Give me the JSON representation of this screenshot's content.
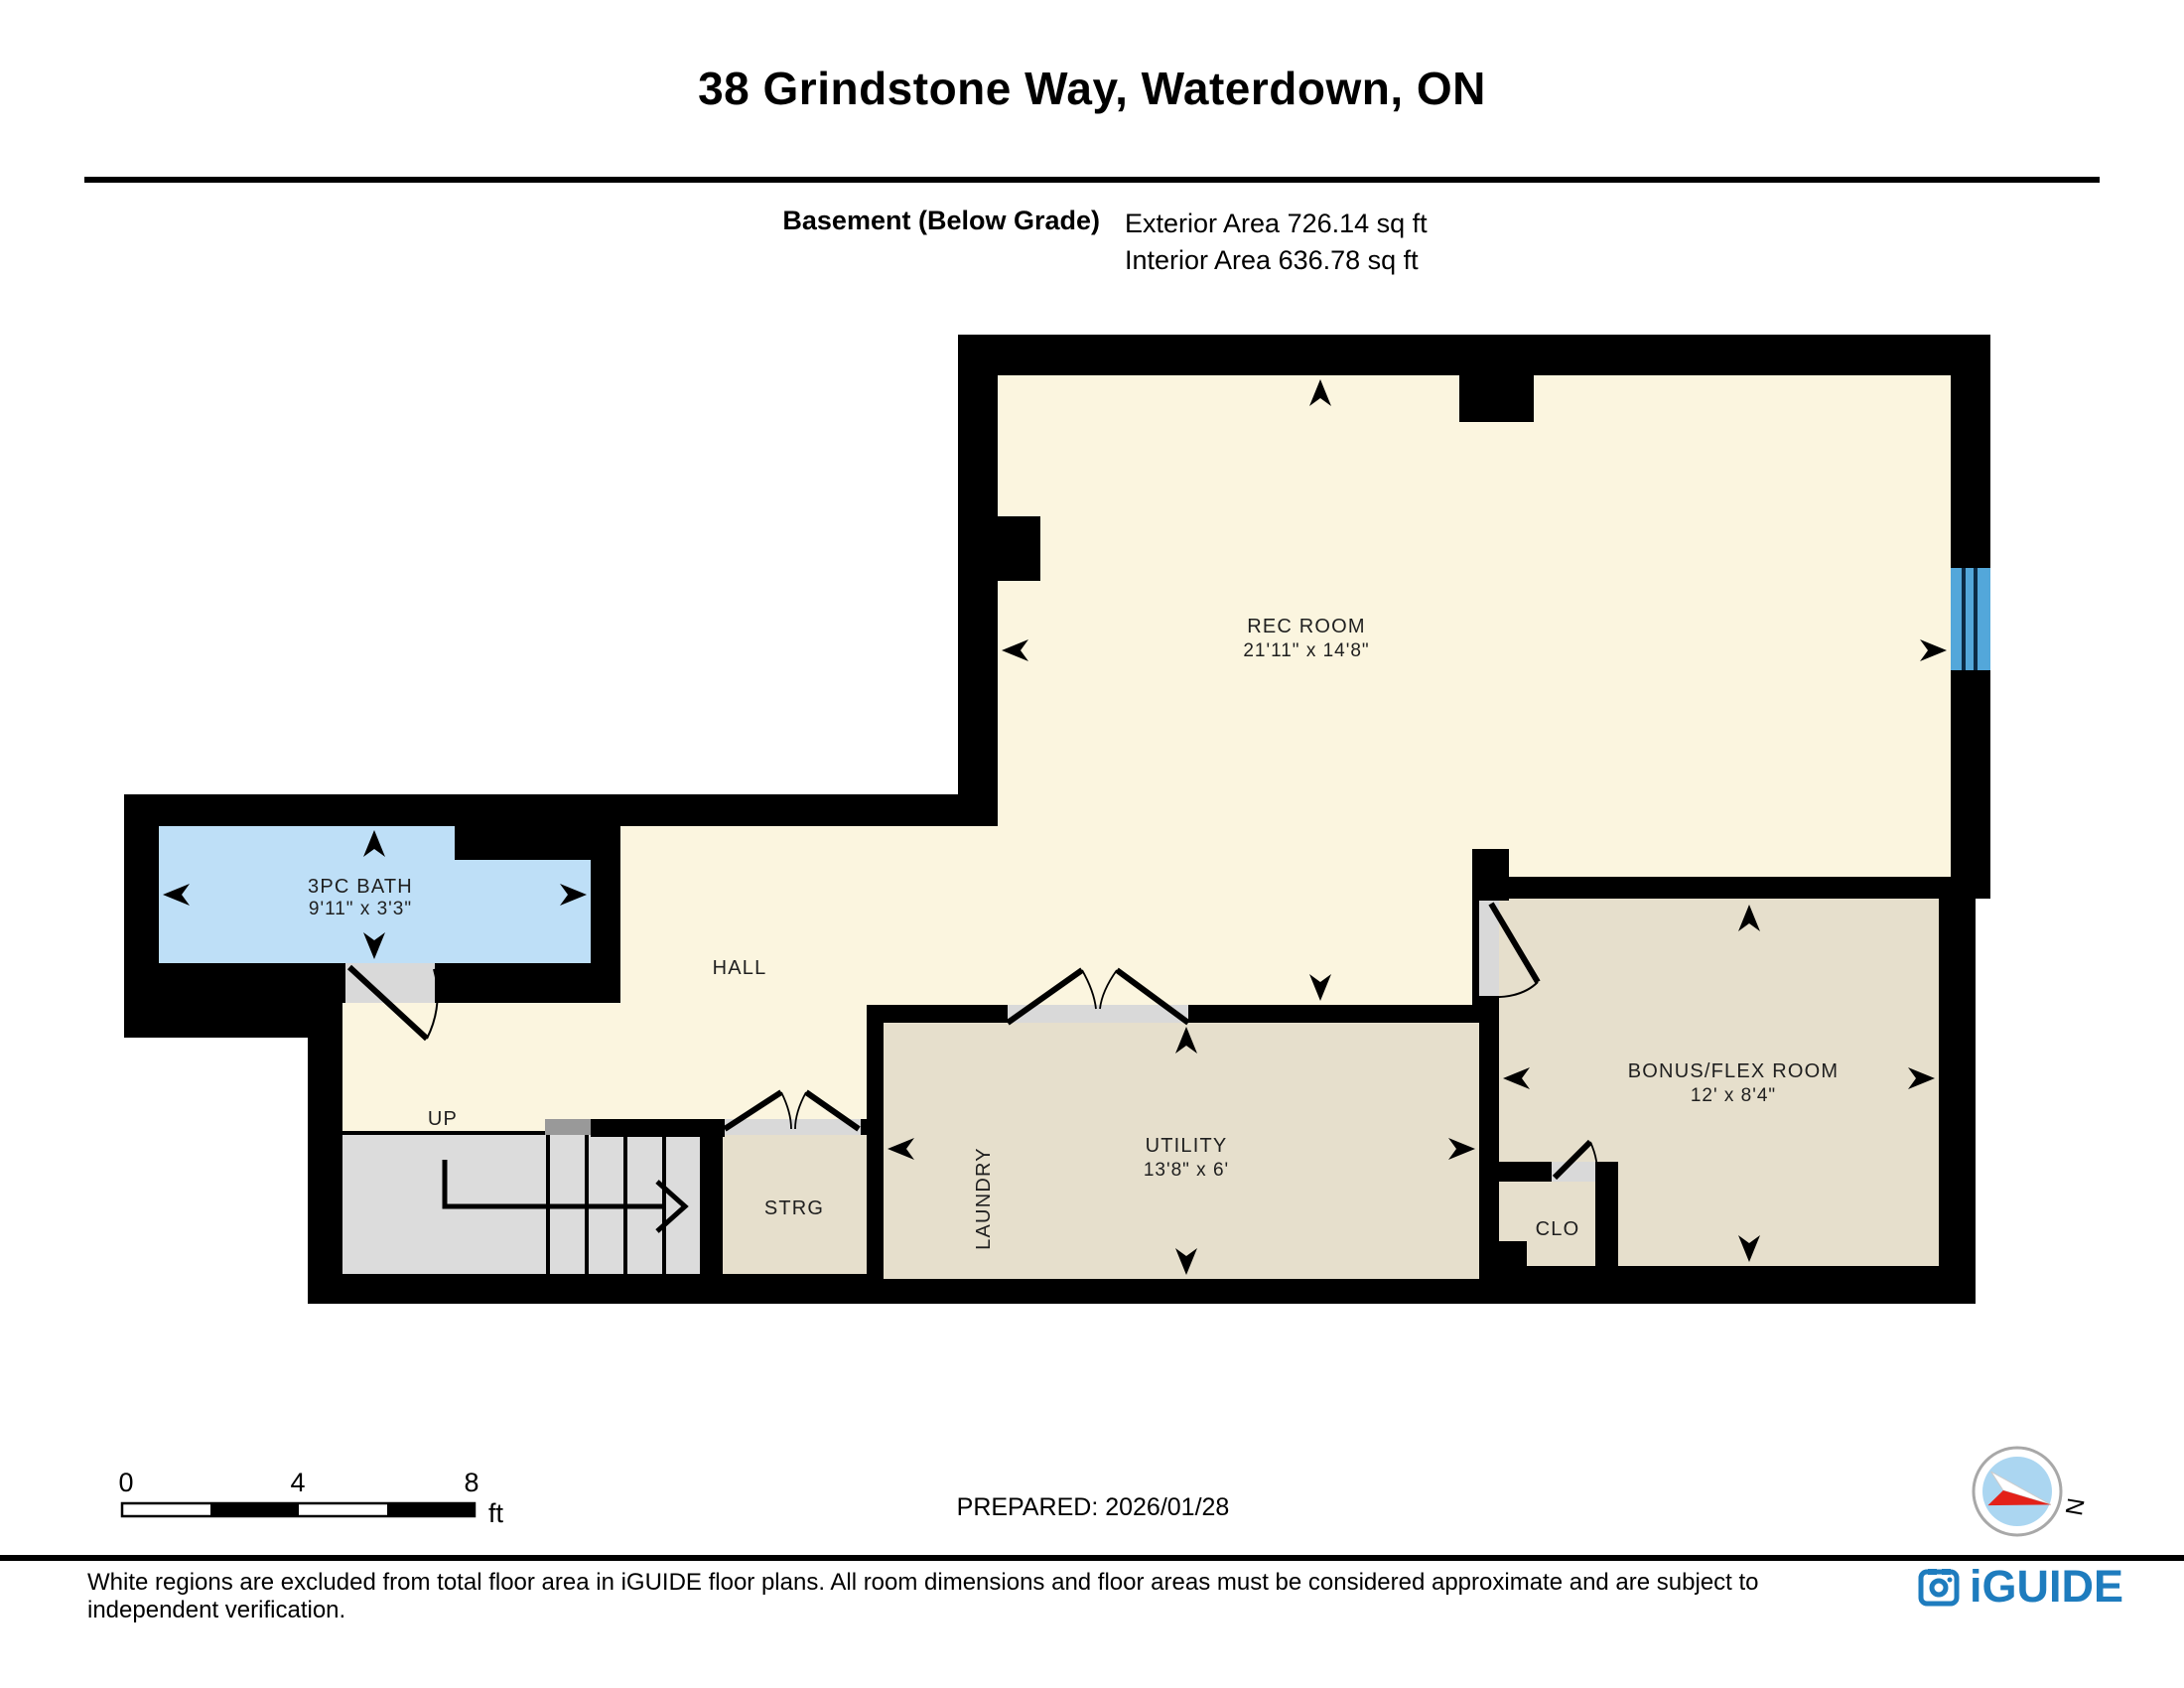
{
  "header": {
    "title": "38 Grindstone Way, Waterdown, ON",
    "floor_label": "Basement (Below Grade)",
    "exterior_area": "Exterior Area 726.14 sq ft",
    "interior_area": "Interior Area 636.78 sq ft"
  },
  "rooms": {
    "rec_room": {
      "name": "REC ROOM",
      "dims": "21'11\" x 14'8\""
    },
    "bath": {
      "name": "3PC BATH",
      "dims": "9'11\" x 3'3\""
    },
    "hall": {
      "name": "HALL"
    },
    "stairs": {
      "name": "UP"
    },
    "storage": {
      "name": "STRG"
    },
    "laundry": {
      "name": "LAUNDRY"
    },
    "utility": {
      "name": "UTILITY",
      "dims": "13'8\" x 6'"
    },
    "closet": {
      "name": "CLO"
    },
    "bonus": {
      "name": "BONUS/FLEX ROOM",
      "dims": "12' x 8'4\""
    }
  },
  "scale_bar": {
    "tick_0": "0",
    "tick_4": "4",
    "tick_8": "8",
    "unit": "ft"
  },
  "prepared_label": "PREPARED: 2026/01/28",
  "compass": {
    "north_label": "N"
  },
  "footer": {
    "disclaimer": "White regions are excluded from total floor area in iGUIDE floor plans. All room dimensions and floor areas must be considered approximate and are subject to independent verification.",
    "brand": "iGUIDE"
  },
  "colors": {
    "wall": "#000000",
    "cream_fill": "#FBF5DF",
    "tan_fill": "#E6DFCC",
    "bath_fill": "#BEDFF7",
    "window_blue": "#53A7DA",
    "stairs_fill": "#DCDCDC",
    "door_opening": "#D9D9D9",
    "brand_blue": "#1E7CBE",
    "compass_red": "#E32119"
  }
}
